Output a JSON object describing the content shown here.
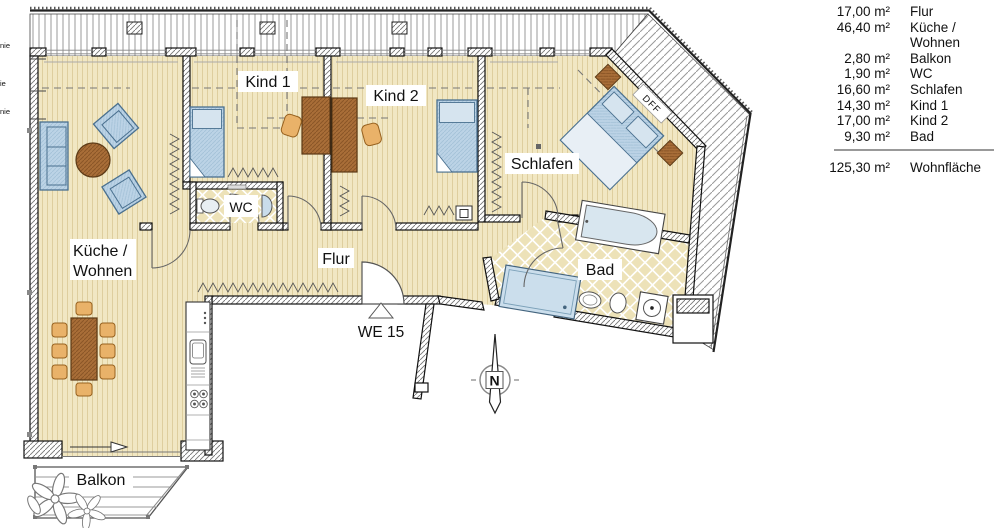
{
  "legend": {
    "rows": [
      {
        "area": "17,00 m²",
        "label": "Flur"
      },
      {
        "area": "46,40 m²",
        "label": "Küche /"
      },
      {
        "area": "",
        "label": "Wohnen"
      },
      {
        "area": "2,80 m²",
        "label": "Balkon"
      },
      {
        "area": "1,90 m²",
        "label": "WC"
      },
      {
        "area": "16,60 m²",
        "label": "Schlafen"
      },
      {
        "area": "14,30 m²",
        "label": "Kind 1"
      },
      {
        "area": "17,00 m²",
        "label": "Kind 2"
      },
      {
        "area": "9,30 m²",
        "label": "Bad"
      }
    ],
    "total": {
      "area": "125,30 m²",
      "label": "Wohnfläche"
    }
  },
  "plan": {
    "rooms": {
      "kueche_line1": "Küche /",
      "kueche_line2": "Wohnen",
      "flur": "Flur",
      "wc": "WC",
      "bad": "Bad",
      "schlafen": "Schlafen",
      "kind1": "Kind 1",
      "kind2": "Kind 2",
      "balkon": "Balkon"
    },
    "annotations": {
      "unit": "WE 15",
      "roof_window": "DFF",
      "compass_north": "N",
      "margin_label_1": "nie",
      "margin_label_2": "ie",
      "margin_label_3": "nie"
    }
  },
  "colors": {
    "floor": "#F1E7C3",
    "floor_stripe": "#DECE9E",
    "tile": "#EDE2B8",
    "furniture_blue": "#BCD3E6",
    "furniture_brown": "#A96E38",
    "chair_tan": "#E9B269"
  }
}
